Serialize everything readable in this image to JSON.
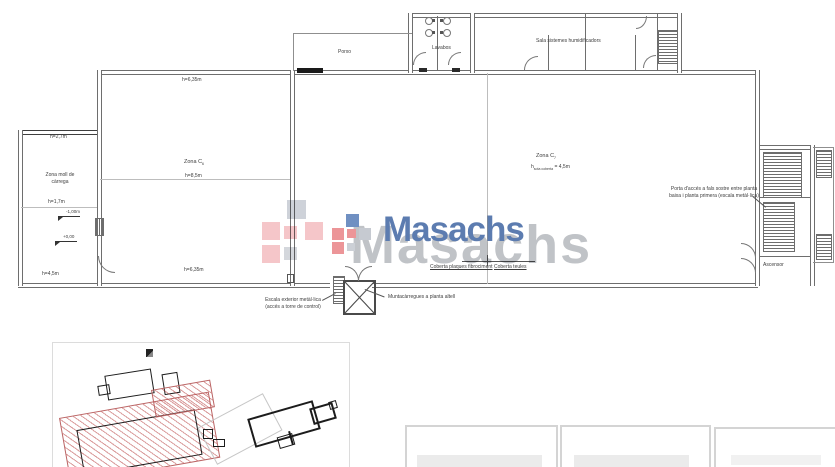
{
  "watermark": {
    "brand": "Masachs",
    "front_color": "#5c7cb0",
    "back_color": "#b6b9be",
    "logo_colors": {
      "red": "#ec9598",
      "pink": "#f3bcbf",
      "blue": "#7090c2",
      "grey": "#c6cad1"
    }
  },
  "plan": {
    "rooms": {
      "porch": "Porxo",
      "toilets": "Lavabos",
      "humidifier_room": "Sala sistemes humidificadors",
      "loading_zone": "Zona moll de càrrega",
      "zone_left": {
        "prefix": "Zona C",
        "sub": "6"
      },
      "zone_right": {
        "prefix": "Zona C",
        "sub": "7"
      },
      "elevator": "Ascensor"
    },
    "heights": {
      "wall_635": "h=6,35m",
      "interior_85": "h=8,5m",
      "loading_27": "h=2,7m",
      "loading_17": "h=1,7m",
      "loading_45": "h=4,5m",
      "under_roof": {
        "prefix": "h",
        "sub": "sota coberta",
        "value": "= 4,5m"
      }
    },
    "levels": {
      "minus_one": "-1,00m",
      "zero": "+0,00"
    },
    "roof": {
      "left": "Coberta plaques fibrociment",
      "right": "Coberta teules"
    },
    "notes": {
      "attic_door_1": "Porta d'accés a fals sostre entre planta",
      "attic_door_2": "baixa i planta primera (escala metàl·lica)",
      "ext_stair_1": "Escala exterior metàl·lica",
      "ext_stair_2": "(accés a torre de control)",
      "freight": "Muntacàrregues a planta altell"
    }
  }
}
